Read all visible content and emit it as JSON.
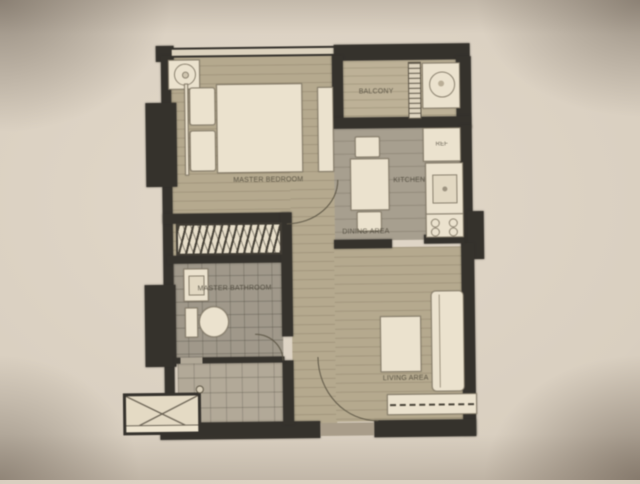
{
  "plan": {
    "rooms": {
      "master_bedroom": {
        "label": "MASTER BEDROOM"
      },
      "balcony": {
        "label": "BALCONY"
      },
      "kitchen": {
        "label": "KITCHEN"
      },
      "dining_area": {
        "label": "DINING AREA"
      },
      "master_bathroom": {
        "label": "MASTER BATHROOM"
      },
      "living_area": {
        "label": "LIVING AREA"
      }
    },
    "appliances": {
      "refrigerator_label": "REF"
    },
    "colors": {
      "wall": "#2e2b26",
      "wood_floor": "#b4a98e",
      "tile_floor": "#9d978b",
      "furniture": "#ece5d4",
      "paper": "#d9cfc0"
    }
  }
}
